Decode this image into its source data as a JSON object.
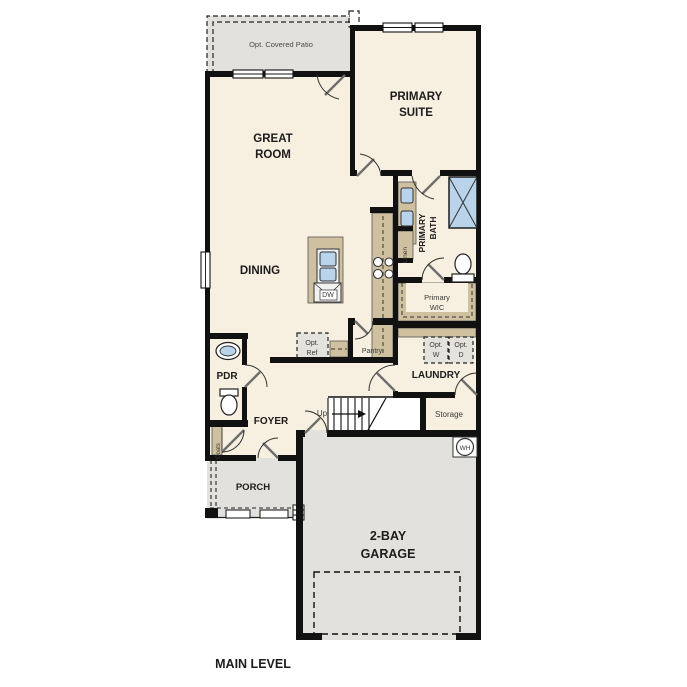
{
  "colors": {
    "room_fill": "#f7efe0",
    "outdoor_fill": "#e2e1dd",
    "cabinet_tan": "#cfc1a0",
    "fixture_blue": "#b8d3ea",
    "wall_black": "#111111"
  },
  "rooms": {
    "patio": "Opt. Covered Patio",
    "primary_suite": [
      "PRIMARY",
      "SUITE"
    ],
    "great_room": [
      "GREAT",
      "ROOM"
    ],
    "primary_bath": [
      "PRIMARY",
      "BATH"
    ],
    "dining": "DINING",
    "primary_wic": [
      "Primary",
      "WIC"
    ],
    "laundry": "LAUNDRY",
    "pdr": "PDR",
    "foyer": "FOYER",
    "porch": "PORCH",
    "garage": [
      "2-BAY",
      "GARAGE"
    ],
    "storage": "Storage",
    "pantry": "Pantry"
  },
  "fixtures": {
    "linen": "Linen",
    "coats": "Coats",
    "dishwasher": "DW",
    "water_heater": "WH",
    "opt_ref": [
      "Opt.",
      "Ref"
    ],
    "opt_washer": [
      "Opt.",
      "W"
    ],
    "opt_dryer": [
      "Opt.",
      "D"
    ],
    "stairs_up": "Up"
  },
  "title": "MAIN LEVEL"
}
